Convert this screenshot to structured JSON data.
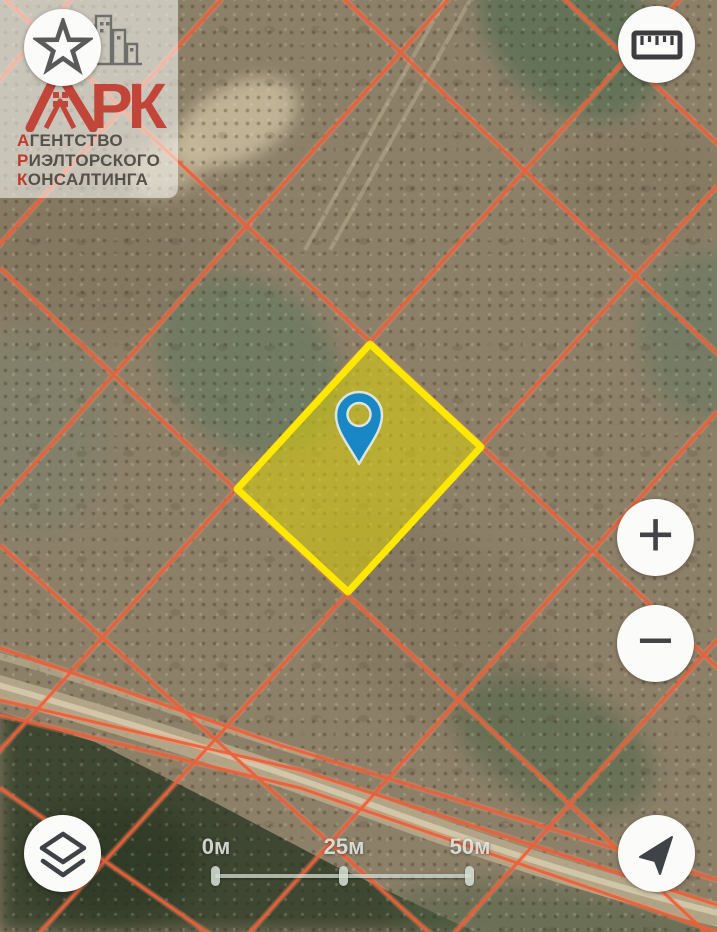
{
  "watermark": {
    "logo_monogram": "РК",
    "lines": [
      {
        "first": "А",
        "rest": "ГЕНТСТВО"
      },
      {
        "first": "Р",
        "rest": "ИЭЛТОРСКОГО"
      },
      {
        "first": "К",
        "rest": "ОНСАЛТИНГА"
      }
    ]
  },
  "controls": {
    "zoom_in_label": "+",
    "zoom_out_label": "−",
    "icons": {
      "favorites": "star-icon",
      "measure": "ruler-icon",
      "layers": "layers-icon",
      "locate": "navigation-arrow-icon",
      "marker": "map-pin-icon"
    }
  },
  "scale_bar": {
    "labels": [
      "0м",
      "25м",
      "50м"
    ]
  },
  "map": {
    "colors": {
      "base-brown": "#8d8069",
      "grid-orange": "#ea6038",
      "grid-halo": "#ff9068",
      "parcel-stroke": "#ffe800",
      "parcel-fill": "rgba(222,210,10,0.55)",
      "pin-blue": "#1987c6",
      "road-tan": "#b9ab8d",
      "forest-green": "#3c4630"
    }
  }
}
